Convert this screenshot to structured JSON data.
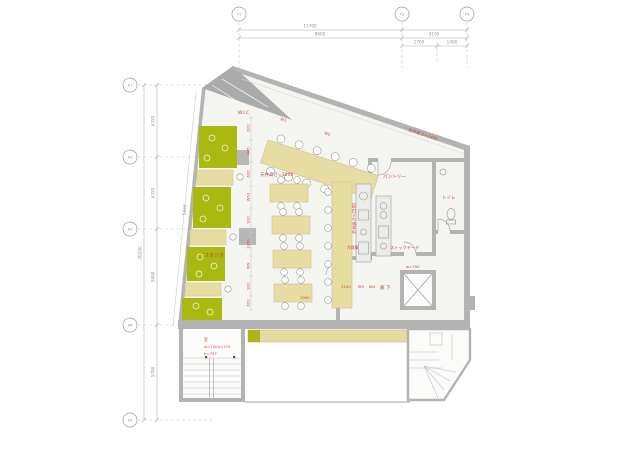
{
  "grid": {
    "y_labels": [
      "Y1",
      "Y2",
      "Y3"
    ],
    "x_labels": [
      "X1",
      "X2",
      "X3",
      "X4",
      "X5"
    ],
    "top_dims": {
      "total": "11700",
      "span_left": "8600",
      "span_right": "3100",
      "sub_left": "1700",
      "sub_right": "1400"
    },
    "left_dims": {
      "total": "20200",
      "s1": "4350",
      "s2": "4350",
      "s3": "5800",
      "s4": "5700",
      "wall": "5940"
    }
  },
  "rooms": {
    "wic": "W.I.C",
    "studio": "スタジオ",
    "pantry": "パントリー",
    "toilet": "トイレ",
    "stockyard": "ストックヤード",
    "corridor": "廊 下"
  },
  "annotations": {
    "ceiling_main": "天井高さ=3200",
    "ceiling_counter": "天井高さ=2500",
    "ceiling_top": "天井高さ=2400",
    "window_l1": "窓",
    "window_l2": "w=700×1170",
    "window_l3": "h=757",
    "ev_note": "w=750",
    "fridge": "冷蔵庫",
    "corridor_dim": "1100",
    "table_dim": "1090",
    "tag_w5": "W5",
    "tag_w4": "W4",
    "tag_w1": "W1",
    "tag_w2": "W2",
    "chain": [
      "620",
      "845",
      "620",
      "W10",
      "910",
      "1370",
      "W9",
      "910",
      "620"
    ]
  },
  "colors": {
    "bench_green": "#a9b90f",
    "table_cream": "#e7dda3",
    "wall_gray": "#b3b3b3",
    "annotation_red": "#c14b38",
    "dim_gray": "#999999"
  }
}
